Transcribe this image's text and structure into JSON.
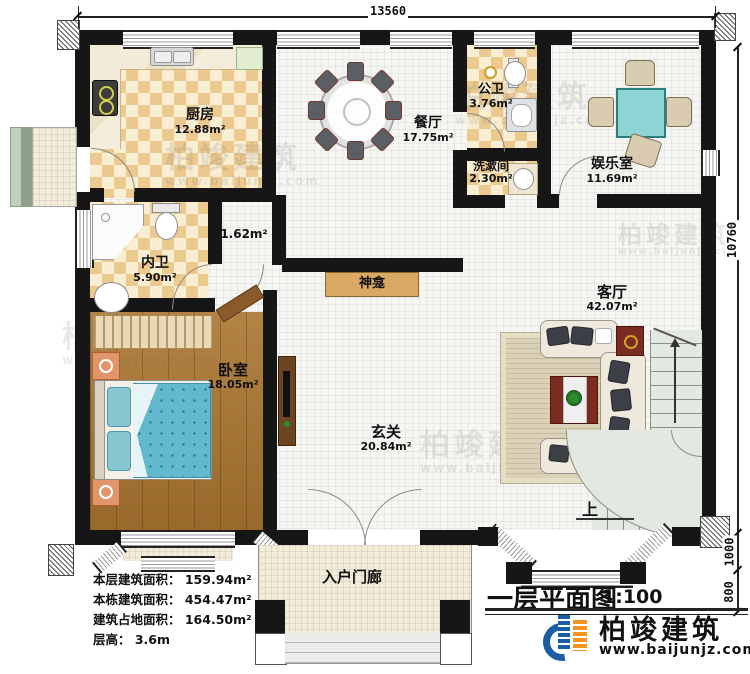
{
  "plan": {
    "title": "一层平面图",
    "scale": "1:100",
    "up": "上",
    "shrine": "神龛",
    "porch": "入户门廊"
  },
  "dims": {
    "top": "13560",
    "right": "10760",
    "right_lower": "1000",
    "right_bottom": "800"
  },
  "rooms": [
    {
      "name": "厨房",
      "area": "12.88m²"
    },
    {
      "name": "餐厅",
      "area": "17.75m²"
    },
    {
      "name": "公卫",
      "area": "3.76m²"
    },
    {
      "name": "洗漱间",
      "area": "2.30m²"
    },
    {
      "name": "娱乐室",
      "area": "11.69m²"
    },
    {
      "name": "内卫",
      "area": "5.90m²"
    },
    {
      "name": "卧室",
      "area": "18.05m²"
    },
    {
      "name": "客厅",
      "area": "42.07m²"
    },
    {
      "name": "玄关",
      "area": "20.84m²"
    },
    {
      "name": "",
      "area": "1.62m²"
    }
  ],
  "info": [
    "本层建筑面积： 159.94m²",
    "本栋建筑面积： 454.47m²",
    "建筑占地面积： 164.50m²",
    "层高： 3.6m"
  ],
  "brand": {
    "name": "柏竣建筑",
    "url": "www.baijunjz.com"
  },
  "colors": {
    "wall": "#161616",
    "checker": "#ecc98e",
    "wood": "#a9752f",
    "brand_blue": "#1b5ea6",
    "brand_orange": "#f7941d",
    "bed_blanket": "#62b8cc",
    "mahjong_table": "#8fd4d4",
    "stairs": "#e3e9e0"
  }
}
